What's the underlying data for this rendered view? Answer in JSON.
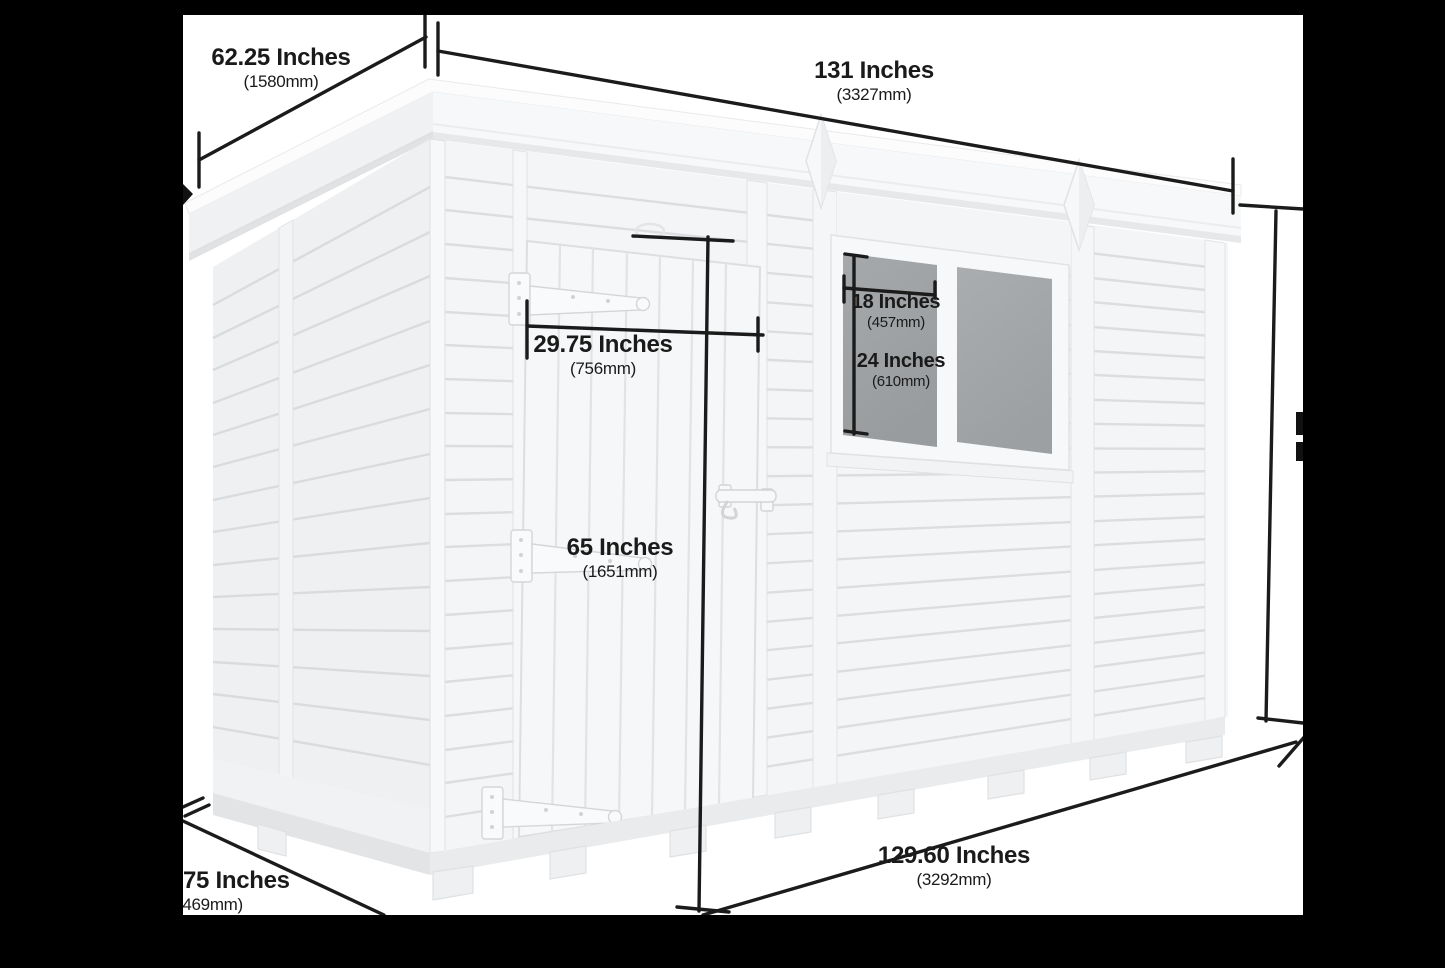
{
  "diagram": {
    "subject": "pent garden shed 3d dimension diagram",
    "background_color": "#000000",
    "image_background": "#ffffff",
    "annotation_color": "#1b1b1b",
    "shed_color": "#f4f5f7",
    "glass_color": "#9da0a2"
  },
  "labels": {
    "roof_depth": {
      "inches": "62.25 Inches",
      "mm": "(1580mm)"
    },
    "roof_width": {
      "inches": "131 Inches",
      "mm": "(3327mm)"
    },
    "door_width": {
      "inches": "29.75 Inches",
      "mm": "(756mm)"
    },
    "window_width": {
      "inches": "18 Inches",
      "mm": "(457mm)"
    },
    "window_height": {
      "inches": "24 Inches",
      "mm": "(610mm)"
    },
    "door_height": {
      "inches": "65 Inches",
      "mm": "(1651mm)"
    },
    "base_width": {
      "inches": "129.60 Inches",
      "mm": "(3292mm)"
    },
    "base_depth_clipped": {
      "inches": "75 Inches",
      "mm": "(469mm)"
    }
  }
}
